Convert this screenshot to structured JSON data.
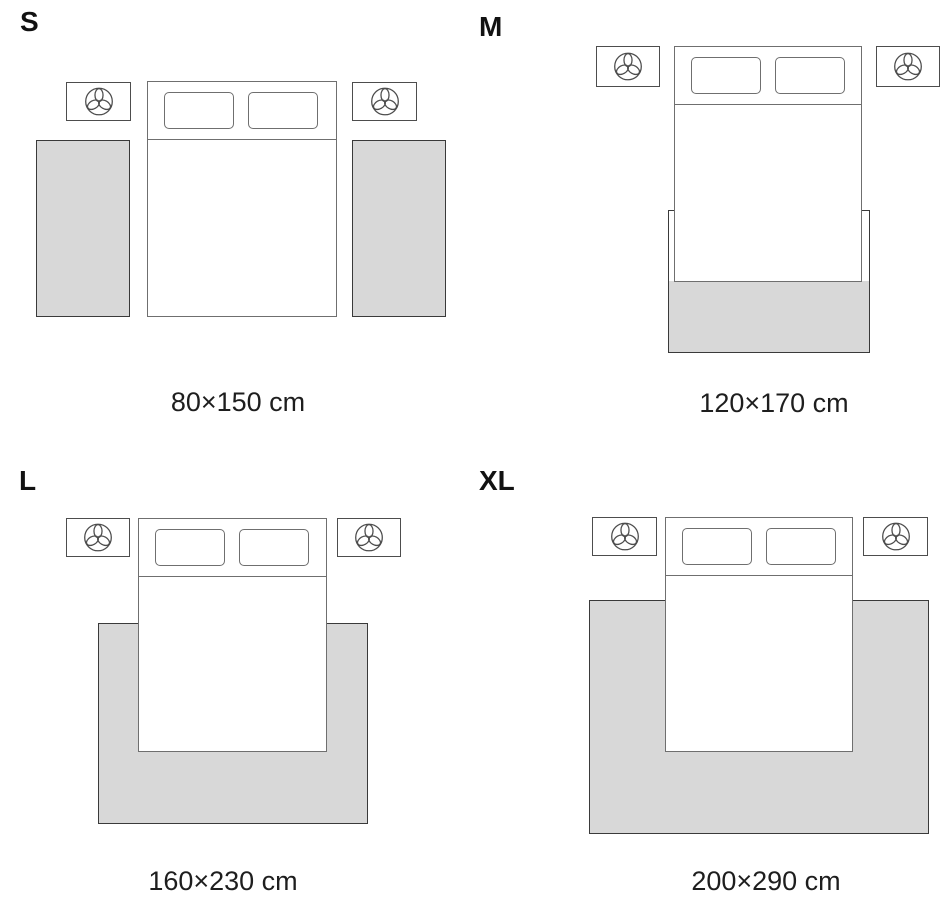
{
  "title": "Rug size guide",
  "colors": {
    "background": "#ffffff",
    "rug_fill": "#d8d8d8",
    "rug_border": "#3a3a3a",
    "furniture_border": "#6f6f6f",
    "nightstand_border": "#4d4d4d",
    "label_text": "#121212",
    "dimension_text": "#1e1e1e"
  },
  "icons": {
    "nightstand_icon": "plant-icon"
  },
  "sizes": [
    {
      "label": "S",
      "dimensions": "80×150 cm"
    },
    {
      "label": "M",
      "dimensions": "120×170 cm"
    },
    {
      "label": "L",
      "dimensions": "160×230 cm"
    },
    {
      "label": "XL",
      "dimensions": "200×290 cm"
    }
  ]
}
